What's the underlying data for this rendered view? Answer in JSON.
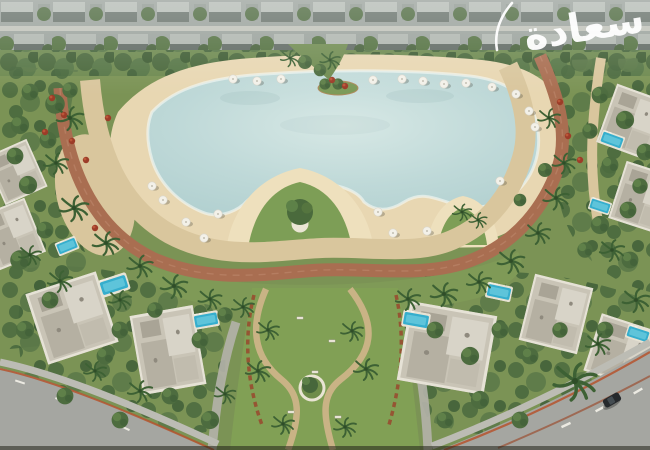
{
  "watermark": {
    "text": "سعادة",
    "color": "#ffffff"
  },
  "palette": {
    "grass": "#7b9355",
    "park_grass": "#81a055",
    "sand": "#e8d7b2",
    "sand_light": "#eee0bd",
    "lagoon_center": "#bfd9d8",
    "lagoon_edge": "#d7e8e5",
    "water_rim": "#f2f7f2",
    "track": "#a96e51",
    "promenade": "#d9c69d",
    "path_tan": "#c9b385",
    "road": "#a5a6a1",
    "sidewalk": "#bcbcb4",
    "curb": "#b5542e",
    "pool": "#36aecd",
    "villa_roof": "#c9c4b6",
    "buildings": "#98a09a",
    "flower": "#9c3c28",
    "car": "#26292c"
  },
  "scene": {
    "villas": [
      [
        72,
        318,
        74,
        74,
        -18
      ],
      [
        168,
        350,
        64,
        80,
        -10
      ],
      [
        16,
        172,
        46,
        52,
        -24
      ],
      [
        12,
        234,
        50,
        58,
        -22
      ],
      [
        447,
        348,
        88,
        80,
        10
      ],
      [
        556,
        314,
        60,
        68,
        14
      ],
      [
        624,
        352,
        66,
        60,
        18
      ],
      [
        632,
        122,
        54,
        62,
        20
      ],
      [
        644,
        198,
        56,
        60,
        18
      ]
    ],
    "pools": [
      [
        114,
        285,
        30,
        18,
        -18
      ],
      [
        206,
        320,
        26,
        16,
        -10
      ],
      [
        67,
        246,
        22,
        14,
        -22
      ],
      [
        416,
        320,
        28,
        17,
        10
      ],
      [
        499,
        292,
        26,
        16,
        12
      ],
      [
        612,
        140,
        24,
        14,
        20
      ],
      [
        600,
        206,
        22,
        13,
        18
      ],
      [
        638,
        334,
        24,
        14,
        18
      ]
    ],
    "decor": [
      {
        "target": "round-trees",
        "symbol": "tree",
        "items": [
          [
            30,
            92,
            1.2
          ],
          [
            55,
            104,
            1.4
          ],
          [
            20,
            125,
            1.3
          ],
          [
            48,
            140,
            1.2
          ],
          [
            70,
            90,
            1.1
          ],
          [
            15,
            156,
            1.2
          ],
          [
            28,
            185,
            1.3
          ],
          [
            45,
            230,
            1.2
          ],
          [
            20,
            260,
            1.4
          ],
          [
            50,
            300,
            1.2
          ],
          [
            25,
            330,
            1.3
          ],
          [
            120,
            330,
            1.2
          ],
          [
            155,
            310,
            1.1
          ],
          [
            105,
            356,
            1.2
          ],
          [
            200,
            340,
            1.2
          ],
          [
            225,
            315,
            1.1
          ],
          [
            170,
            396,
            1.2
          ],
          [
            210,
            420,
            1.3
          ],
          [
            120,
            420,
            1.2
          ],
          [
            65,
            396,
            1.2
          ],
          [
            435,
            330,
            1.2
          ],
          [
            470,
            356,
            1.3
          ],
          [
            500,
            330,
            1.2
          ],
          [
            530,
            356,
            1.2
          ],
          [
            560,
            330,
            1.1
          ],
          [
            480,
            400,
            1.3
          ],
          [
            520,
            420,
            1.2
          ],
          [
            445,
            420,
            1.2
          ],
          [
            605,
            330,
            1.2
          ],
          [
            630,
            260,
            1.2
          ],
          [
            600,
            225,
            1.3
          ],
          [
            628,
            210,
            1.2
          ],
          [
            585,
            250,
            1.1
          ],
          [
            600,
            95,
            1.2
          ],
          [
            625,
            120,
            1.3
          ],
          [
            645,
            152,
            1.2
          ],
          [
            590,
            131,
            1.1
          ],
          [
            610,
            165,
            1.2
          ],
          [
            640,
            186,
            1.1
          ],
          [
            545,
            170,
            1.0
          ],
          [
            520,
            200,
            0.9
          ],
          [
            305,
            62,
            1.0
          ],
          [
            320,
            70,
            0.9
          ],
          [
            338,
            84,
            0.8
          ],
          [
            325,
            84,
            0.8
          ]
        ]
      },
      {
        "target": "palm-trees",
        "symbol": "palm",
        "items": [
          [
            70,
            118,
            1.2
          ],
          [
            56,
            163,
            1.1
          ],
          [
            74,
            208,
            1.3
          ],
          [
            106,
            243,
            1.2
          ],
          [
            140,
            266,
            1.15
          ],
          [
            174,
            286,
            1.2
          ],
          [
            210,
            299,
            1.05
          ],
          [
            243,
            307,
            1.0
          ],
          [
            408,
            299,
            1.1
          ],
          [
            444,
            294,
            1.2
          ],
          [
            479,
            282,
            1.1
          ],
          [
            511,
            261,
            1.2
          ],
          [
            538,
            233,
            1.1
          ],
          [
            556,
            198,
            1.15
          ],
          [
            564,
            163,
            1.05
          ],
          [
            549,
            118,
            1.0
          ],
          [
            268,
            330,
            1.0
          ],
          [
            352,
            331,
            1.0
          ],
          [
            258,
            371,
            1.1
          ],
          [
            366,
            369,
            1.1
          ],
          [
            283,
            424,
            1.0
          ],
          [
            345,
            427,
            1.0
          ],
          [
            575,
            381,
            1.9
          ],
          [
            120,
            300,
            1.0
          ],
          [
            60,
            281,
            1.1
          ],
          [
            30,
            255,
            1.0
          ],
          [
            140,
            391,
            1.1
          ],
          [
            95,
            371,
            1.0
          ],
          [
            225,
            394,
            0.95
          ],
          [
            612,
            250,
            1.1
          ],
          [
            636,
            300,
            1.2
          ],
          [
            598,
            344,
            1.1
          ],
          [
            462,
            212,
            0.85
          ],
          [
            478,
            220,
            0.8
          ],
          [
            330,
            60,
            0.9
          ],
          [
            290,
            58,
            0.85
          ]
        ]
      },
      {
        "target": "flower-bushes",
        "symbol": "flower",
        "items": [
          [
            52,
            98
          ],
          [
            64,
            115
          ],
          [
            45,
            132
          ],
          [
            72,
            141
          ],
          [
            560,
            102
          ],
          [
            568,
            136
          ],
          [
            580,
            160
          ],
          [
            332,
            80
          ],
          [
            345,
            86
          ],
          [
            108,
            118
          ],
          [
            86,
            160
          ],
          [
            95,
            228
          ]
        ]
      },
      {
        "target": "benches",
        "symbol": "bench",
        "items": [
          [
            300,
            318
          ],
          [
            332,
            341
          ],
          [
            291,
            412
          ],
          [
            338,
            417
          ],
          [
            315,
            372
          ]
        ]
      },
      {
        "target": "beach-umbrellas",
        "symbol": "umbrella",
        "items": [
          [
            233,
            79
          ],
          [
            257,
            81
          ],
          [
            281,
            79
          ],
          [
            373,
            80
          ],
          [
            402,
            79
          ],
          [
            423,
            81
          ],
          [
            444,
            84
          ],
          [
            466,
            83
          ],
          [
            492,
            87
          ],
          [
            516,
            94
          ],
          [
            529,
            111
          ],
          [
            535,
            127
          ],
          [
            152,
            186
          ],
          [
            163,
            200
          ],
          [
            186,
            222
          ],
          [
            218,
            214
          ],
          [
            204,
            238
          ],
          [
            378,
            212
          ],
          [
            393,
            233
          ],
          [
            427,
            231
          ],
          [
            500,
            181
          ]
        ]
      }
    ]
  }
}
